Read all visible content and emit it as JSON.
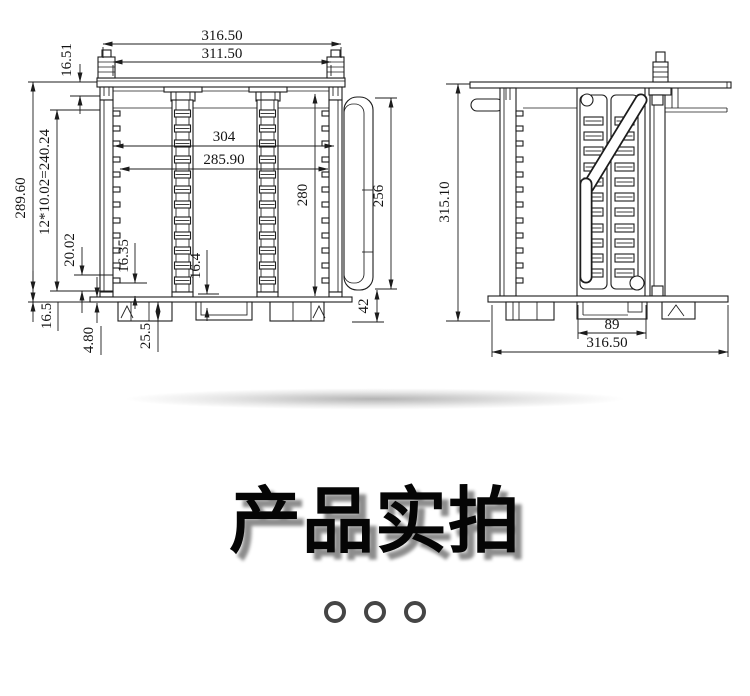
{
  "drawing": {
    "front_view": {
      "dim_overall_width": "316.50",
      "dim_inner_width": "311.50",
      "dim_knob_height": "16.51",
      "dim_overall_height": "289.60",
      "dim_slot_pitch": "12*10.02=240.24",
      "dim_guide_span": "304",
      "dim_card_span": "285.90",
      "dim_inner_height": "280",
      "dim_handle_height": "256",
      "dim_20_02": "20.02",
      "dim_16_35": "16.35",
      "dim_16_4": "16.4",
      "dim_16_5": "16.5",
      "dim_4_80": "4.80",
      "dim_25_5": "25.5",
      "dim_42": "42"
    },
    "side_view": {
      "dim_overall_height": "315.10",
      "dim_tray_width": "89",
      "dim_overall_width": "316.50"
    }
  },
  "section": {
    "title": "产品实拍"
  },
  "carousel": {
    "dot_count": 3
  },
  "colors": {
    "line": "#1c1c1c",
    "title_shadow": "#8d8d8d",
    "dot_ring": "#454545"
  }
}
